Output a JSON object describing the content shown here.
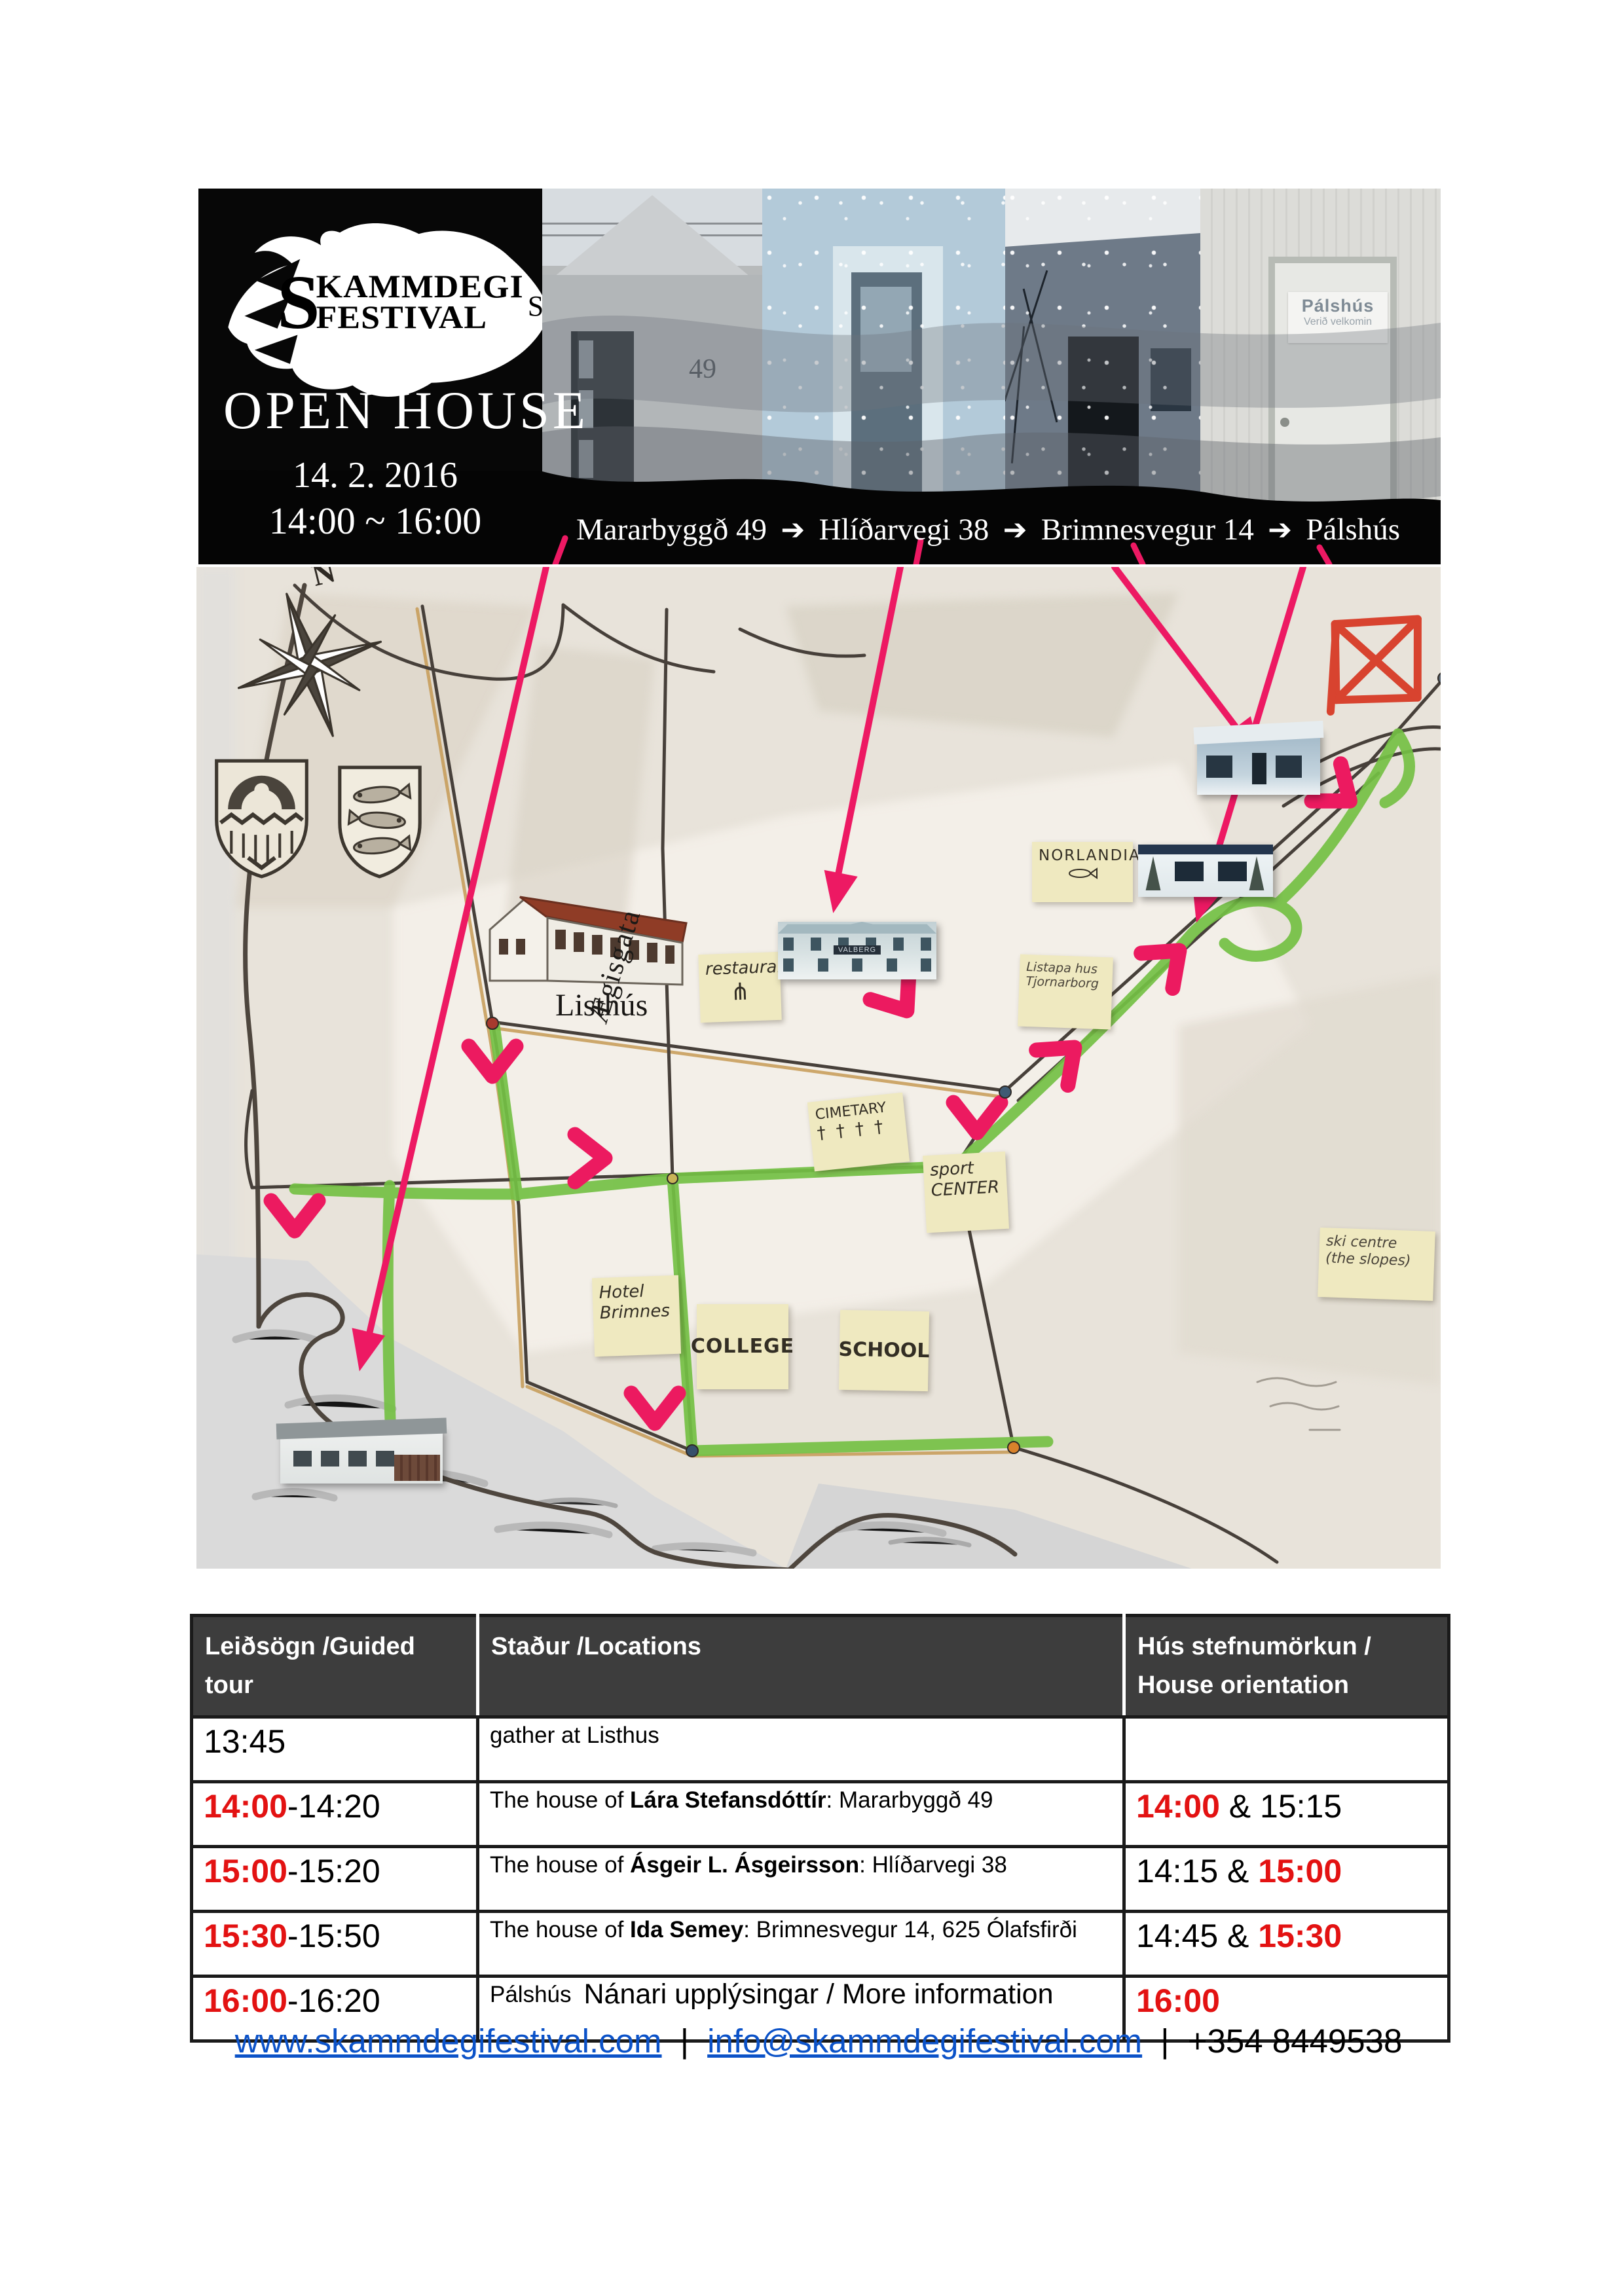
{
  "banner": {
    "logo": {
      "s": "S",
      "line1": "KAMMDEGI",
      "line2": "FESTIVAL",
      "suffix": "Shátið"
    },
    "title": "OPEN HOUSE",
    "date": "14. 2. 2016",
    "time": "14:00 ~ 16:00",
    "route": {
      "stops": [
        "Mararbyggð 49",
        "Hlíðarvegi 38",
        "Brimnesvegur 14",
        "Pálshús"
      ],
      "arrow": "➔"
    },
    "photos": {
      "house49_number": "49",
      "palshus_sign_title": "Pálshús",
      "palshus_sign_sub": "Verið velkomin"
    }
  },
  "map": {
    "compass_n": "N",
    "listhus_label": "Listhús",
    "street_label": "Ægisgata",
    "valberg_sign": "VALBERG",
    "notes": {
      "restaurant": {
        "line1": "restaurant",
        "icon": "⋔"
      },
      "norlandia": {
        "line1": "NORLANDIA"
      },
      "tjarnarborg": {
        "line1": "Listapa hus",
        "line2": "Tjornarborg"
      },
      "cemetery": {
        "line1": "CIMETARY",
        "line2": "† † † †"
      },
      "sport": {
        "line1": "sport",
        "line2": "CENTER"
      },
      "hotel": {
        "line1": "Hotel",
        "line2": "Brimnes"
      },
      "college": {
        "line1": "COLLEGE"
      },
      "school": {
        "line1": "SCHOOL"
      },
      "ski": {
        "line1": "ski centre",
        "line2": "(the slopes)"
      }
    }
  },
  "table": {
    "headers": [
      "Leiðsögn /Guided tour",
      "Staður /Locations",
      "Hús stefnumörkun / House orientation"
    ],
    "rows": [
      {
        "time": [
          {
            "t": "13:45"
          }
        ],
        "location": [
          {
            "t": "gather at Listhus"
          }
        ],
        "orientation": []
      },
      {
        "time": [
          {
            "t": "14:00",
            "red": true,
            "bold": true
          },
          {
            "t": "-14:20"
          }
        ],
        "location": [
          {
            "t": "The house of "
          },
          {
            "t": "Lára Stefansdóttír",
            "bold": true
          },
          {
            "t": ": Mararbyggð 49"
          }
        ],
        "orientation": [
          {
            "t": "14:00",
            "red": true,
            "bold": true
          },
          {
            "t": " & 15:15"
          }
        ]
      },
      {
        "time": [
          {
            "t": "15:00",
            "red": true,
            "bold": true
          },
          {
            "t": "-15:20"
          }
        ],
        "location": [
          {
            "t": "The house of "
          },
          {
            "t": "Ásgeir L. Ásgeirsson",
            "bold": true
          },
          {
            "t": ": Hlíðarvegi 38"
          }
        ],
        "orientation": [
          {
            "t": "14:15 & "
          },
          {
            "t": "15:00",
            "red": true,
            "bold": true
          }
        ]
      },
      {
        "time": [
          {
            "t": "15:30",
            "red": true,
            "bold": true
          },
          {
            "t": "-15:50"
          }
        ],
        "location": [
          {
            "t": "The house of "
          },
          {
            "t": "Ida Semey",
            "bold": true
          },
          {
            "t": ": Brimnesvegur 14, 625 Ólafsfirði"
          }
        ],
        "orientation": [
          {
            "t": "14:45 & "
          },
          {
            "t": "15:30",
            "red": true,
            "bold": true
          }
        ]
      },
      {
        "time": [
          {
            "t": "16:00",
            "red": true,
            "bold": true
          },
          {
            "t": "-16:20"
          }
        ],
        "location": [
          {
            "t": "Pálshús"
          }
        ],
        "orientation": [
          {
            "t": "16:00",
            "red": true,
            "bold": true
          }
        ]
      }
    ]
  },
  "footer": {
    "info": "Nánari upplýsingar / More information",
    "website": "www.skammdegifestival.com",
    "email": "info@skammdegifestival.com",
    "phone": "+354 8449538",
    "separator": "|"
  },
  "colors": {
    "route_green": "#74c044",
    "arrow_pink": "#ed1963",
    "marker_red": "#d8432f",
    "time_red": "#e31212",
    "link_blue": "#0b52c8",
    "note_yellow": "#efe9c0",
    "header_gray": "#3d3d3d"
  }
}
